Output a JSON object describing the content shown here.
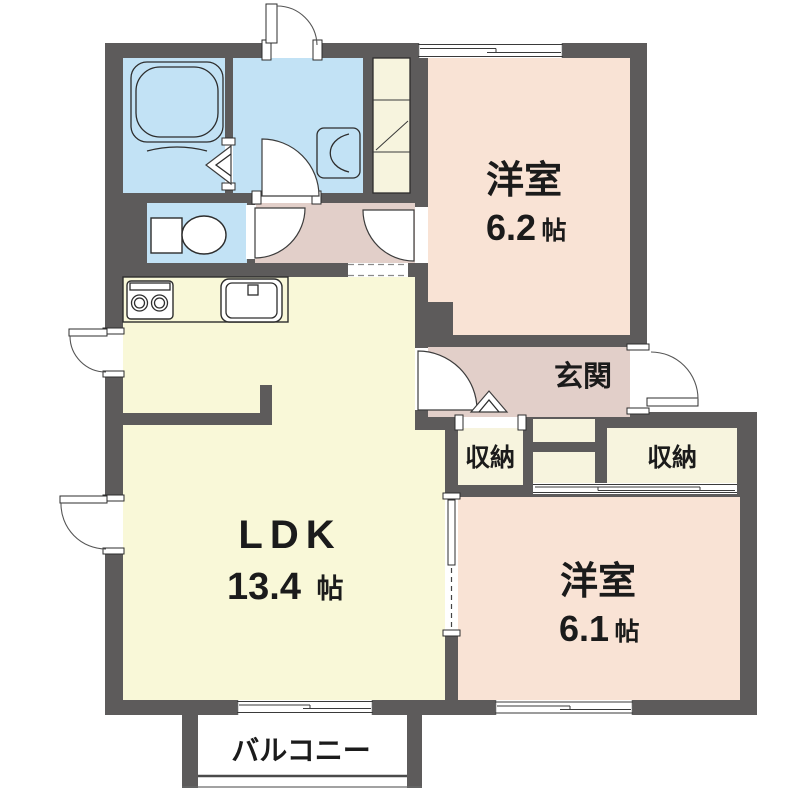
{
  "plan": {
    "type": "japanese-apartment-floor-plan",
    "rooms": {
      "bedroom_top": {
        "name": "洋室",
        "size_value": "6.2",
        "size_unit": "帖"
      },
      "bedroom_bottom": {
        "name": "洋室",
        "size_value": "6.1",
        "size_unit": "帖"
      },
      "ldk": {
        "name": "LDK",
        "size_value": "13.4",
        "size_unit": "帖"
      },
      "entrance": {
        "name": "玄関"
      },
      "storage_left": {
        "name": "収納"
      },
      "storage_right": {
        "name": "収納"
      },
      "balcony": {
        "name": "バルコニー"
      }
    },
    "fixtures": [
      "bathtub",
      "bathroom-folding-door",
      "vanity-basin",
      "toilet",
      "kitchen-stove",
      "kitchen-sink",
      "tall-cabinet",
      "entry-step-chevron"
    ],
    "colors": {
      "wall": "#5d5b5b",
      "wet_room_blue": "#c2e2f5",
      "bedroom_pink": "#f9e3d5",
      "hall_mauve": "#e2cfc9",
      "ldk_yellow": "#f9f8d8",
      "storage_cream": "#f7f4de",
      "outline": "#2d2d2d",
      "background": "#ffffff"
    }
  }
}
